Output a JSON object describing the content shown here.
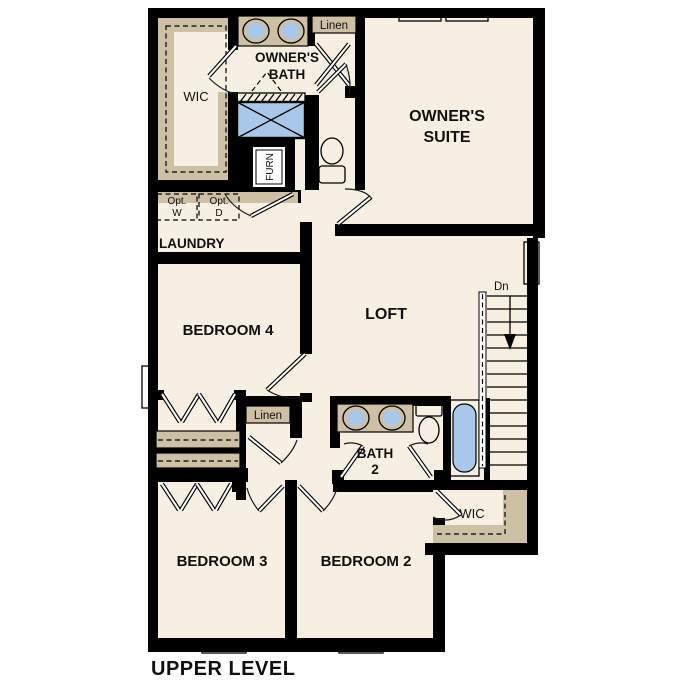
{
  "title": "UPPER LEVEL",
  "colors": {
    "floor": "#f7f0e2",
    "wall": "#000000",
    "tan": "#cdc0a5",
    "fixture_blue": "#a9c8e9",
    "appliance_gray": "#e2e2e2",
    "white": "#ffffff"
  },
  "rooms": {
    "owners_suite": {
      "line1": "OWNER'S",
      "line2": "SUITE"
    },
    "owners_bath": {
      "line1": "OWNER'S",
      "line2": "BATH"
    },
    "wic_top": {
      "label": "WIC"
    },
    "linen_top": {
      "label": "Linen"
    },
    "furnace": {
      "label": "FURN"
    },
    "laundry": {
      "label": "LAUNDRY"
    },
    "opt_washer": {
      "line1": "Opt.",
      "line2": "W"
    },
    "opt_dryer": {
      "line1": "Opt.",
      "line2": "D"
    },
    "bedroom4": {
      "label": "BEDROOM 4"
    },
    "loft": {
      "label": "LOFT"
    },
    "stairs": {
      "label": "Dn"
    },
    "linen_mid": {
      "label": "Linen"
    },
    "bath2": {
      "line1": "BATH",
      "line2": "2"
    },
    "wic_bottom": {
      "label": "WIC"
    },
    "bedroom3": {
      "label": "BEDROOM 3"
    },
    "bedroom2": {
      "label": "BEDROOM 2"
    }
  }
}
